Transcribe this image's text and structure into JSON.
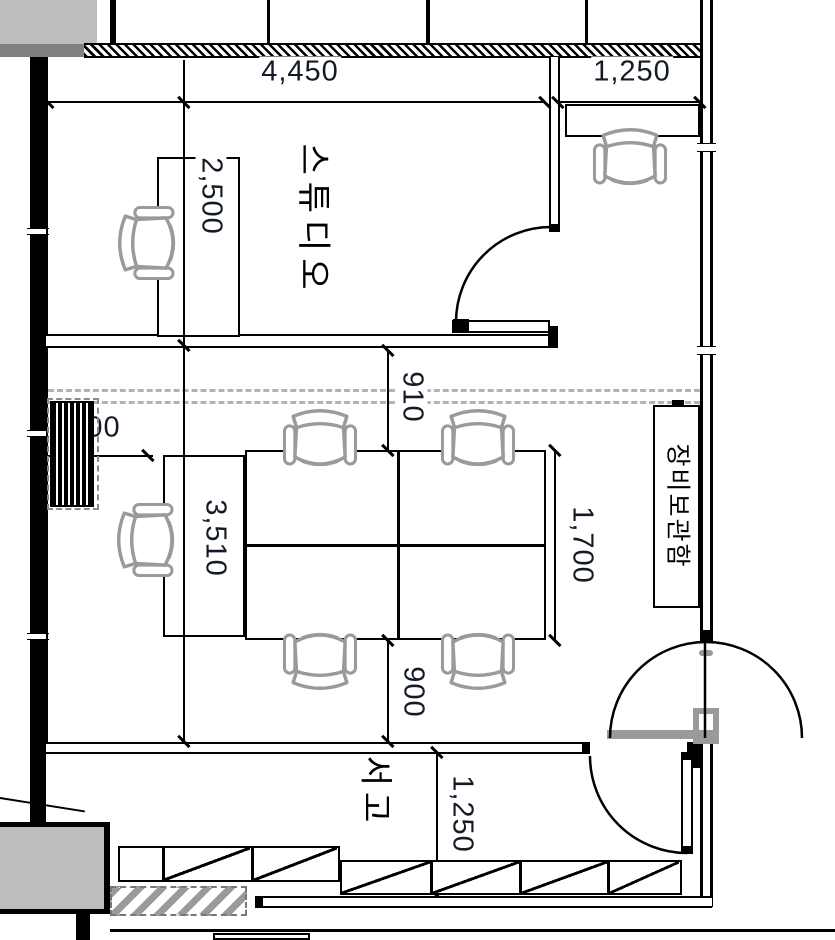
{
  "plan": {
    "type": "architectural-floor-plan",
    "rooms": {
      "studio": "스튜디오",
      "equipment_storage": "장비보관함",
      "stack_room": "서고"
    },
    "dimensions": {
      "studio_width": "4,450",
      "right_bay_width": "1,250",
      "studio_desk_depth": "2,500",
      "wall_to_table": "910",
      "meeting_room_depth": "3,510",
      "table_length": "1,700",
      "table_to_wall": "900",
      "wall_to_desk": "900",
      "stack_room_depth": "1,250"
    },
    "colors": {
      "line": "#000000",
      "furniture_outline": "#9a9a9a",
      "reference_dashed": "#b3b3b3",
      "wall_mass_fill": "#bdbdbd",
      "dimension_text": "#141a26"
    }
  }
}
